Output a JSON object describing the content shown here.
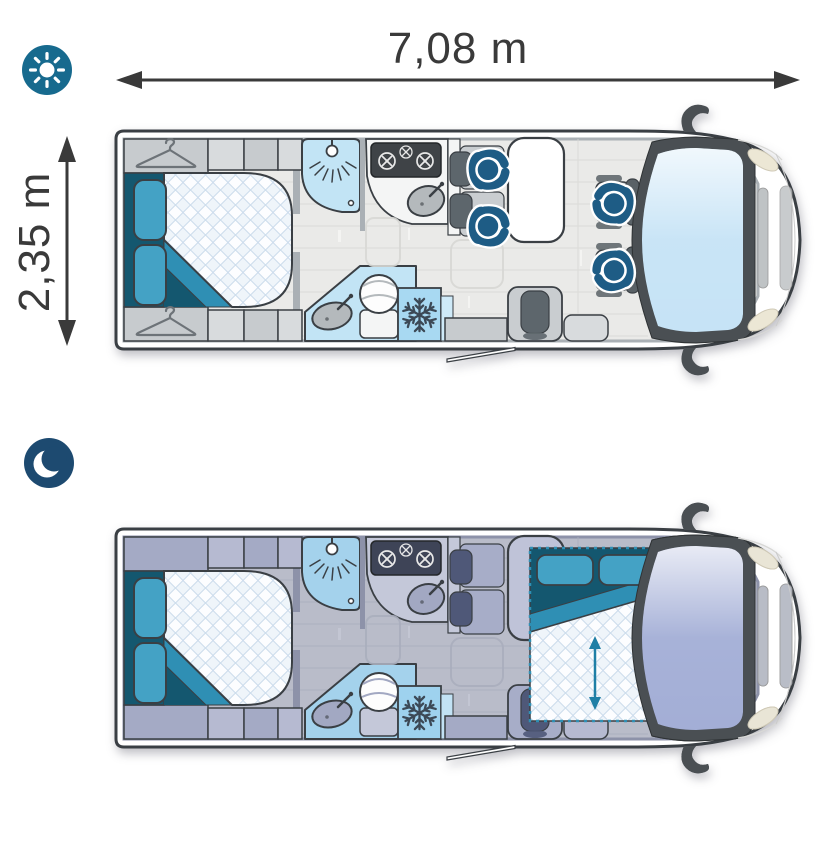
{
  "dimensions": {
    "length_label": "7,08 m",
    "width_label": "2,35 m",
    "arrow_color": "#3a3a3a"
  },
  "modes": [
    {
      "id": "day",
      "icon": "sun-icon",
      "badge_color": "#176a8e"
    },
    {
      "id": "night",
      "icon": "moon-icon",
      "badge_color": "#1d4a70"
    }
  ],
  "floorplan_features": {
    "shared": [
      "rear-double-bed",
      "wardrobes",
      "shower",
      "kitchen-stove",
      "kitchen-sink",
      "washroom-sink",
      "toilet",
      "refrigerator-freezer",
      "dinette-table",
      "bench-seats",
      "single-seat",
      "cab-swivel-seats",
      "windshield",
      "side-mirrors",
      "entry-door-open"
    ],
    "day_only": [
      "hanger-icons",
      "four-passenger-figures"
    ],
    "night_only": [
      "drop-down-front-bed",
      "bed-lowering-arrow"
    ]
  },
  "palettes": {
    "day": {
      "outline": "#3a3f44",
      "wall": "#aab0b5",
      "floor": "#eaeae8",
      "floorLine": "#d8d8d5",
      "floorStreak": "#f4f4f2",
      "furn": "#c7cbce",
      "furnLight": "#d8dbdd",
      "counter": "#f4f5f5",
      "seat": "#c9cdd0",
      "headrest": "#5d666c",
      "table": "#ffffff",
      "stove": "#3f4347",
      "shower": "#c2e4f5",
      "freezer": "#a8d9f2",
      "freezer2": "#cfeaf8",
      "fixture": "#b4b9bc",
      "glass": "#c6e3f6",
      "accent": "#44a2c5",
      "accentMid": "#2f8fb4",
      "accentDark": "#14576f",
      "frame": "#4a4f53",
      "headlight": "#ece7d5",
      "grille": "#bfc3c5",
      "cabSeat": "#c2c7ca",
      "cabSeatDark": "#596166",
      "person": "#1e5c85"
    },
    "night": {
      "outline": "#3a3f44",
      "wall": "#8d92a9",
      "floor": "#b9bcc9",
      "floorLine": "#aaaebd",
      "floorStreak": "#c3c6d3",
      "furn": "#a4aac5",
      "furnLight": "#b6bad1",
      "counter": "#c4c8d9",
      "seat": "#a7adc8",
      "headrest": "#4f5878",
      "table": "#bfc3d8",
      "stove": "#3e4457",
      "shower": "#a4d2ec",
      "freezer": "#9ed2ee",
      "freezer2": "#c2e2f4",
      "fixture": "#a2a8c2",
      "glass": "#a3aed6",
      "accent": "#44a2c5",
      "accentMid": "#2f8fb4",
      "accentDark": "#14576f",
      "frame": "#4a4f53",
      "headlight": "#e9e5d6",
      "grille": "#b8bcc6",
      "cabSeat": "#8a90ad",
      "cabSeatDark": "#4c5475",
      "person": "#1e5c85"
    }
  }
}
